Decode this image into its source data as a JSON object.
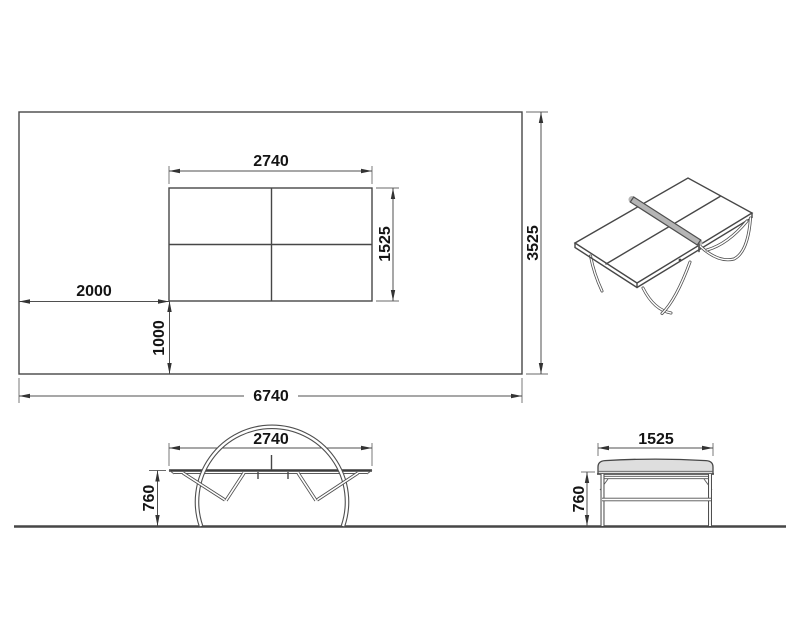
{
  "drawing": {
    "type": "technical-dimension-drawing",
    "subject": "table tennis table with room clearance layout",
    "units_implied": "mm"
  },
  "colors": {
    "line": "#474747",
    "text": "#141414",
    "net_fill": "#b5b5b5",
    "slab_fill": "#dedede",
    "background": "#ffffff"
  },
  "plan_view": {
    "table_length": "2740",
    "table_width": "1525",
    "clearance_left": "2000",
    "clearance_bottom": "1000",
    "room_length": "6740",
    "room_width": "3525"
  },
  "front_view": {
    "table_length": "2740",
    "table_height": "760"
  },
  "side_view": {
    "table_width": "1525",
    "table_height": "760"
  }
}
